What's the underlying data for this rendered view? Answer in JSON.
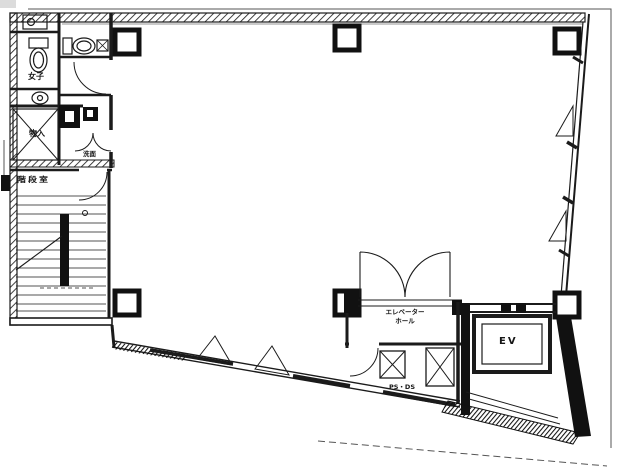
{
  "drawing": {
    "kind": "architectural floor plan (scanned, office building typical floor)",
    "line_color": "#1b1b1b",
    "paper_color": "#ffffff"
  },
  "labels": {
    "elevator": "EV",
    "stairwell": "階段室",
    "wc": "女子",
    "storage": "物入",
    "washroom": "洗面",
    "hall_line1": "エレベーター",
    "hall_line2": "ホール",
    "pipe_shaft": "PS・DS"
  }
}
